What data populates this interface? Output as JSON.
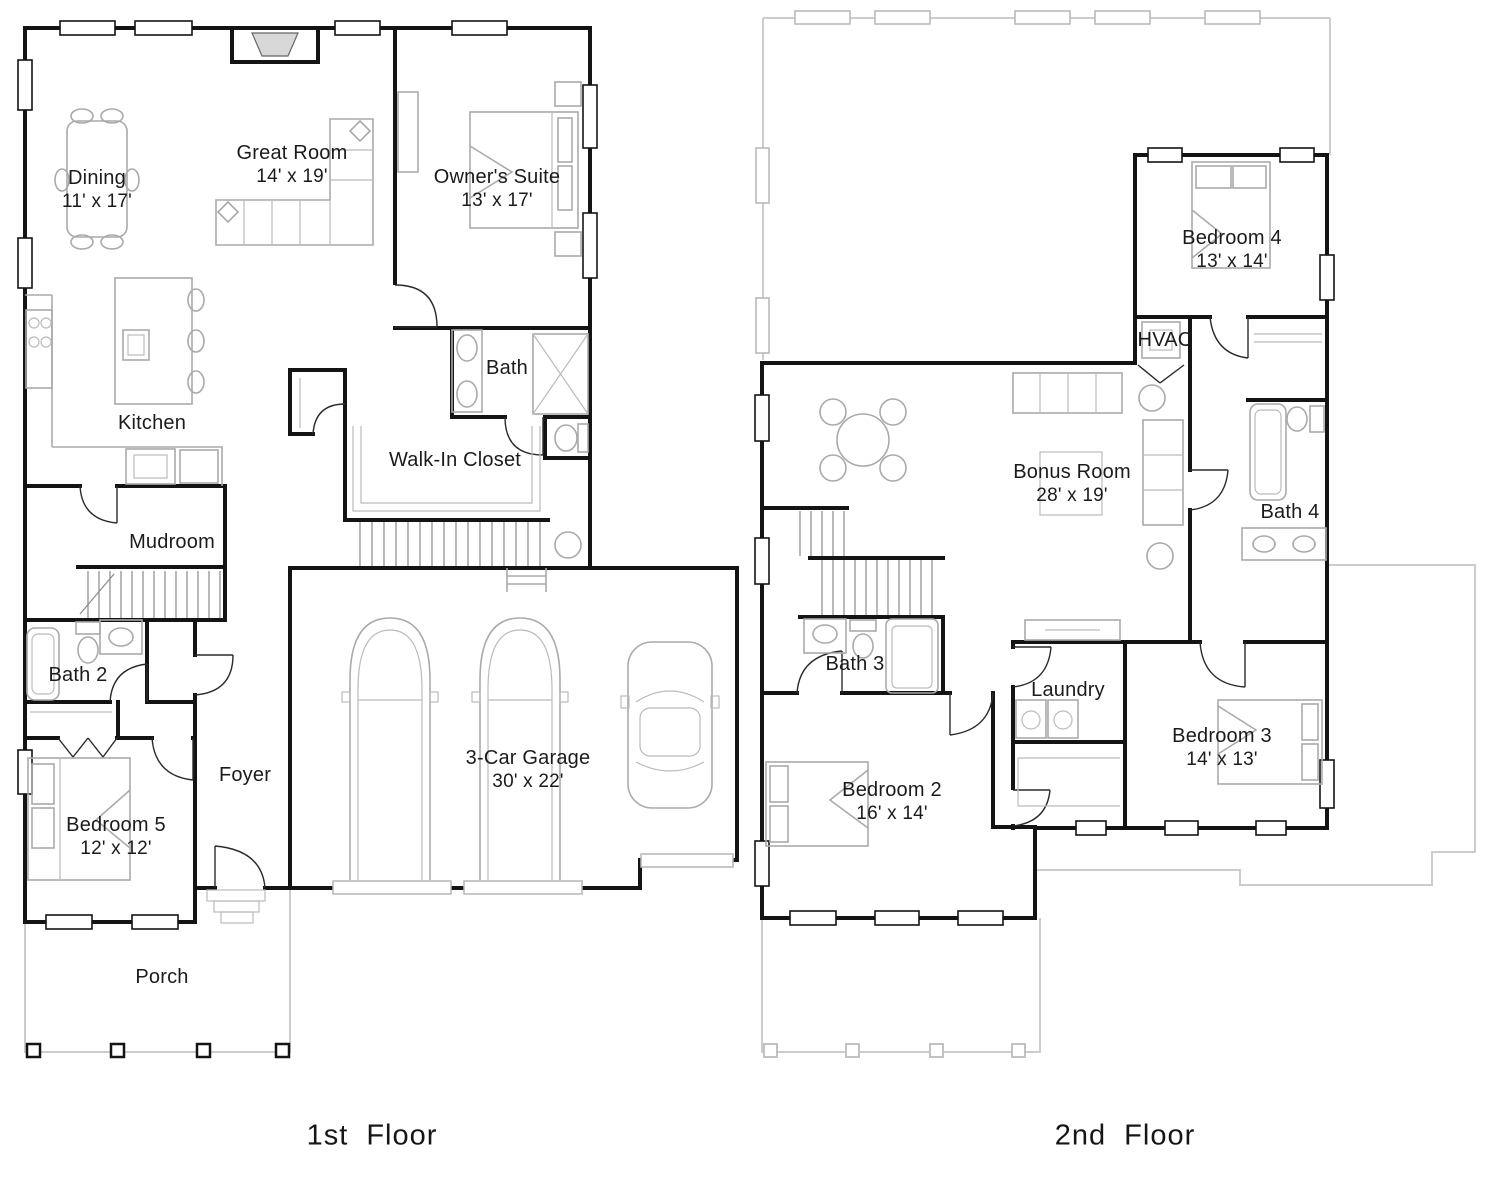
{
  "colors": {
    "background": "#ffffff",
    "wall": "#141414",
    "furniture": "#aaaaaa",
    "ghost_outline": "#cccccc",
    "text": "#1b1b1b"
  },
  "floors": [
    {
      "id": "first-floor",
      "caption": "1st Floor",
      "rooms": [
        {
          "key": "dining",
          "name": "Dining",
          "dims": "11' x 17'"
        },
        {
          "key": "great-room",
          "name": "Great Room",
          "dims": "14' x 19'"
        },
        {
          "key": "owners-suite",
          "name": "Owner's Suite",
          "dims": "13' x 17'"
        },
        {
          "key": "bath",
          "name": "Bath",
          "dims": ""
        },
        {
          "key": "kitchen",
          "name": "Kitchen",
          "dims": ""
        },
        {
          "key": "walk-in-closet",
          "name": "Walk-In Closet",
          "dims": ""
        },
        {
          "key": "mudroom",
          "name": "Mudroom",
          "dims": ""
        },
        {
          "key": "bath-2",
          "name": "Bath 2",
          "dims": ""
        },
        {
          "key": "foyer",
          "name": "Foyer",
          "dims": ""
        },
        {
          "key": "bedroom-5",
          "name": "Bedroom 5",
          "dims": "12' x 12'"
        },
        {
          "key": "three-car-garage",
          "name": "3-Car Garage",
          "dims": "30' x 22'"
        },
        {
          "key": "porch",
          "name": "Porch",
          "dims": ""
        }
      ]
    },
    {
      "id": "second-floor",
      "caption": "2nd Floor",
      "rooms": [
        {
          "key": "bedroom-4",
          "name": "Bedroom 4",
          "dims": "13' x 14'"
        },
        {
          "key": "hvac",
          "name": "HVAC",
          "dims": ""
        },
        {
          "key": "bonus-room",
          "name": "Bonus Room",
          "dims": "28' x 19'"
        },
        {
          "key": "bath-4",
          "name": "Bath 4",
          "dims": ""
        },
        {
          "key": "bath-3",
          "name": "Bath 3",
          "dims": ""
        },
        {
          "key": "laundry",
          "name": "Laundry",
          "dims": ""
        },
        {
          "key": "bedroom-2",
          "name": "Bedroom 2",
          "dims": "16' x 14'"
        },
        {
          "key": "bedroom-3",
          "name": "Bedroom 3",
          "dims": "14' x 13'"
        }
      ]
    }
  ]
}
